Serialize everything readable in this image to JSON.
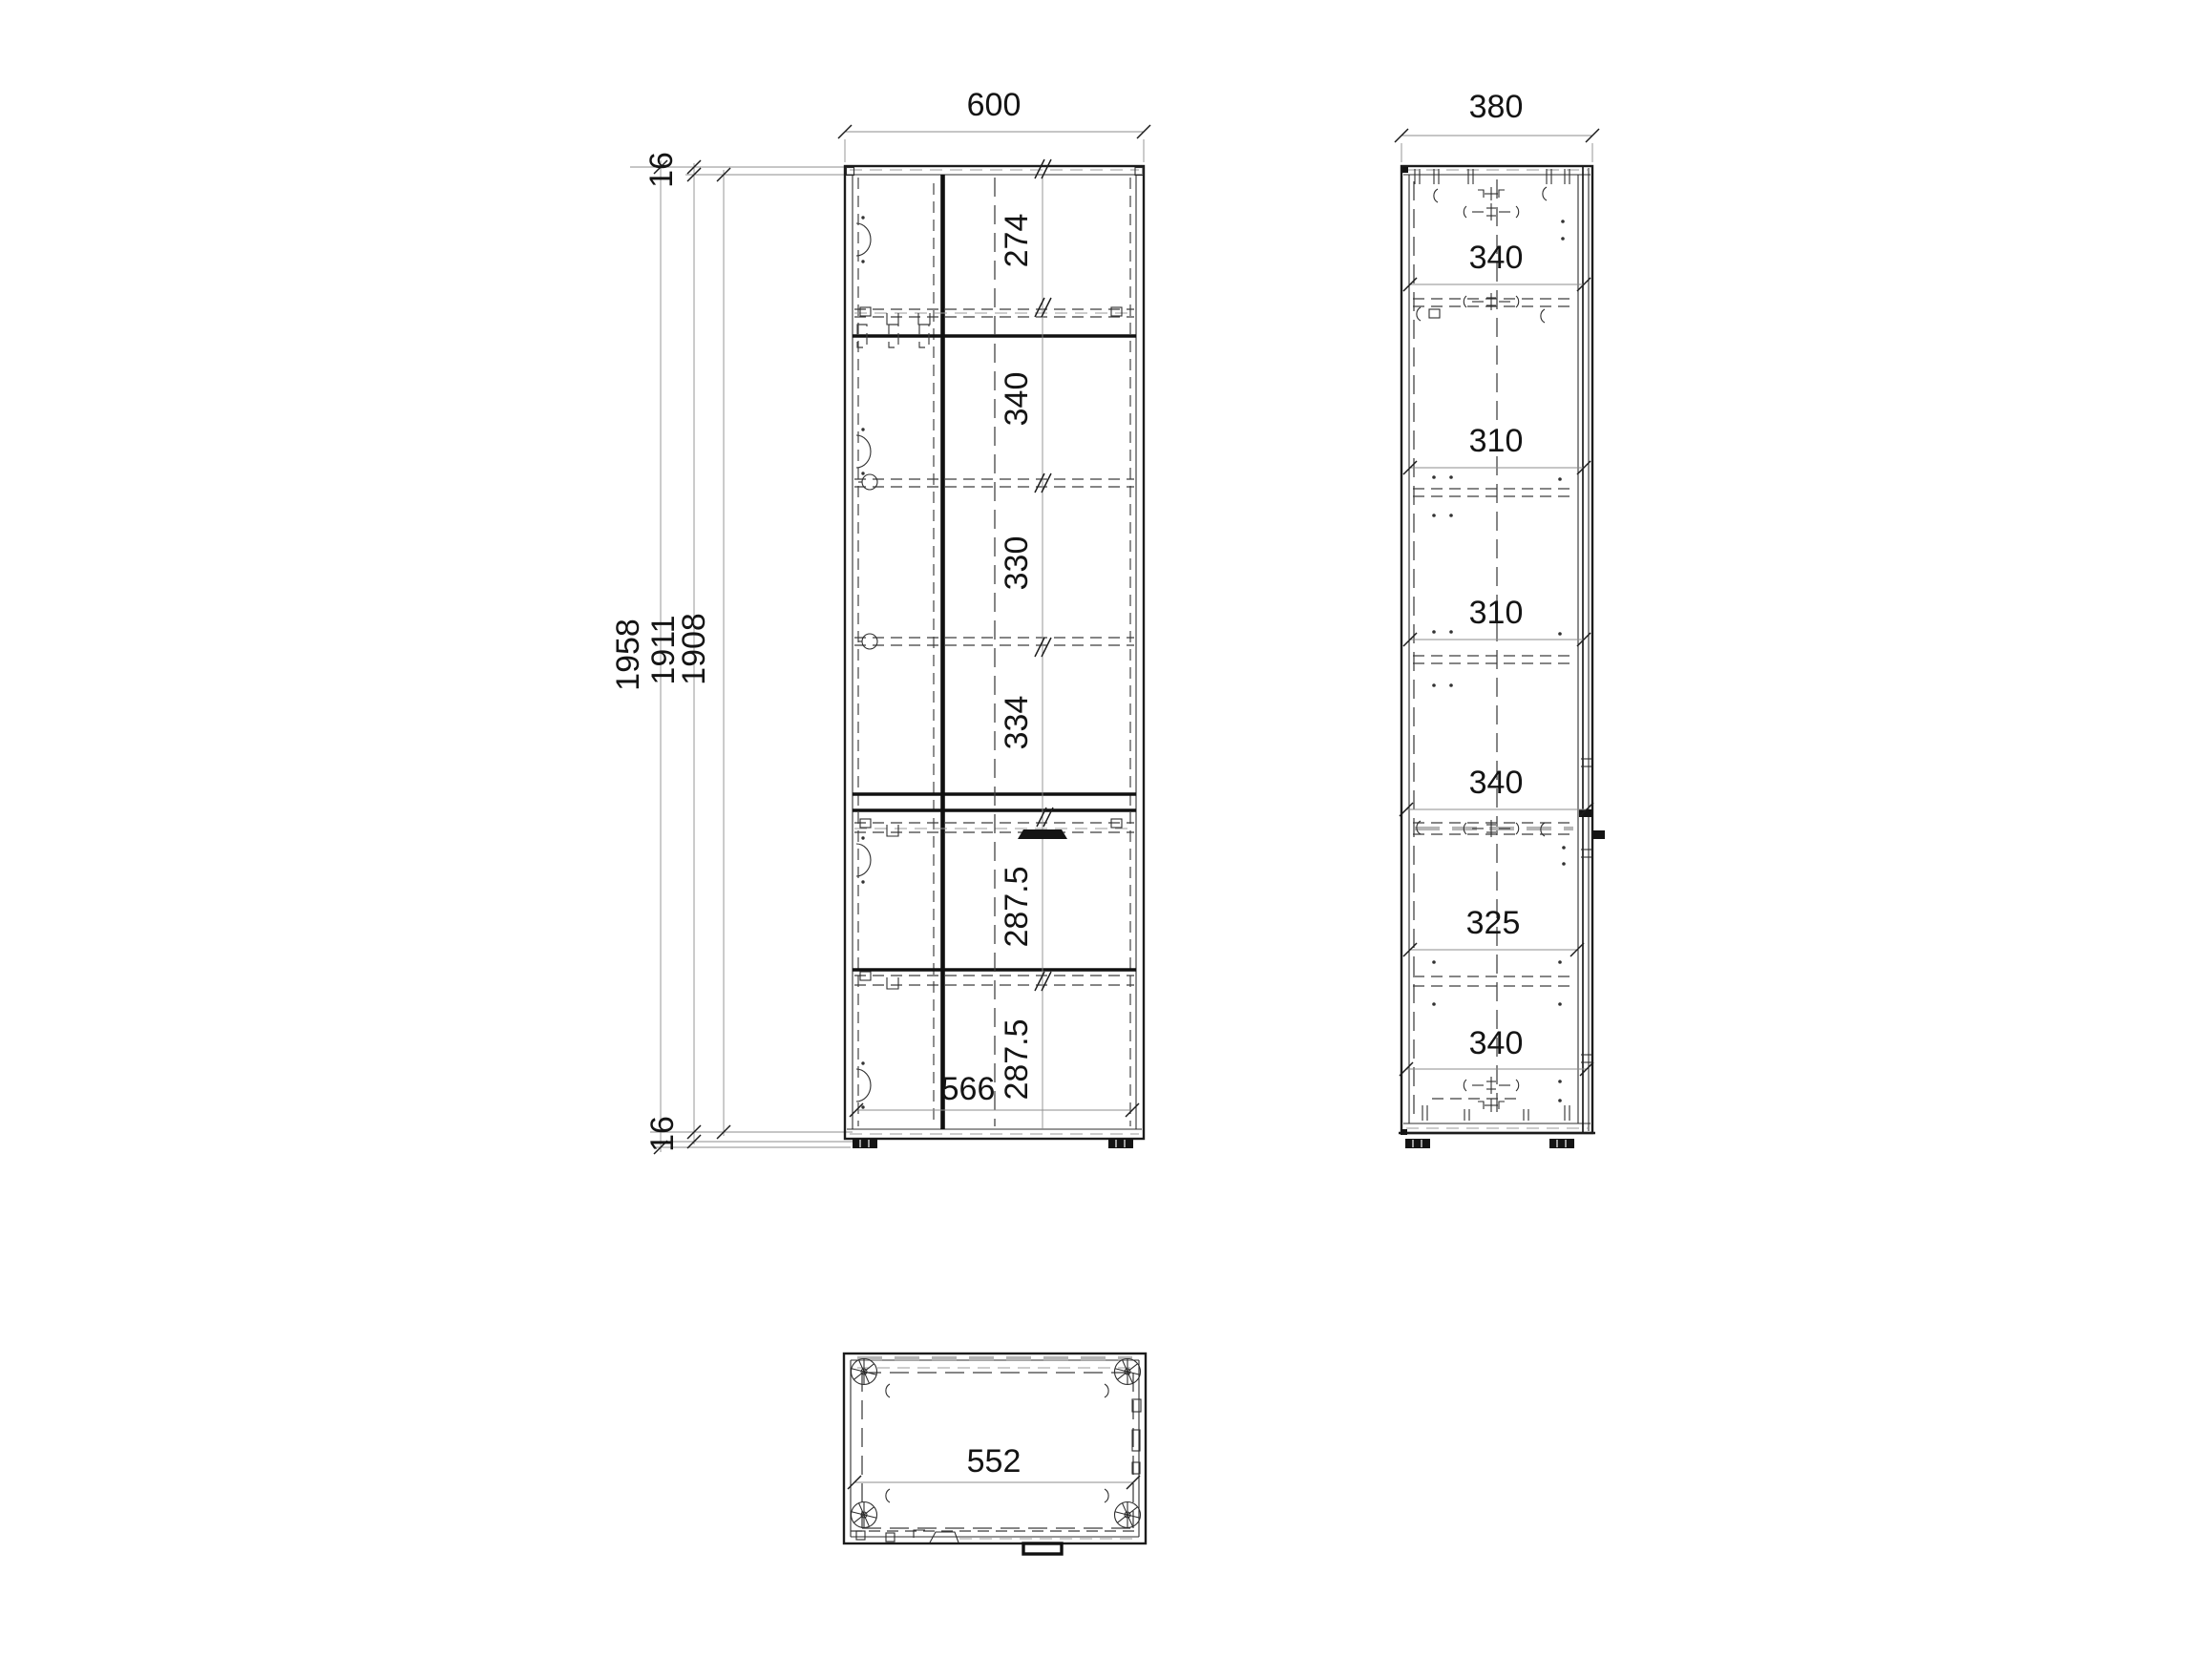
{
  "front_view": {
    "width": "600",
    "board_top": "16",
    "board_bottom": "16",
    "heights": [
      "1958",
      "1911",
      "1908"
    ],
    "sections": [
      "274",
      "340",
      "330",
      "334",
      "287.5",
      "287.5"
    ],
    "inner_width": "566"
  },
  "side_view": {
    "width": "380",
    "depths": [
      "340",
      "310",
      "310",
      "340",
      "325",
      "340"
    ]
  },
  "top_view": {
    "inner_width": "552"
  },
  "colors": {
    "ink": "#1c1c1c",
    "paper": "#ffffff",
    "dim_line": "#8c8c8c",
    "hidden_line": "#3c3c3c",
    "light_gray": "#b5b5b5"
  }
}
